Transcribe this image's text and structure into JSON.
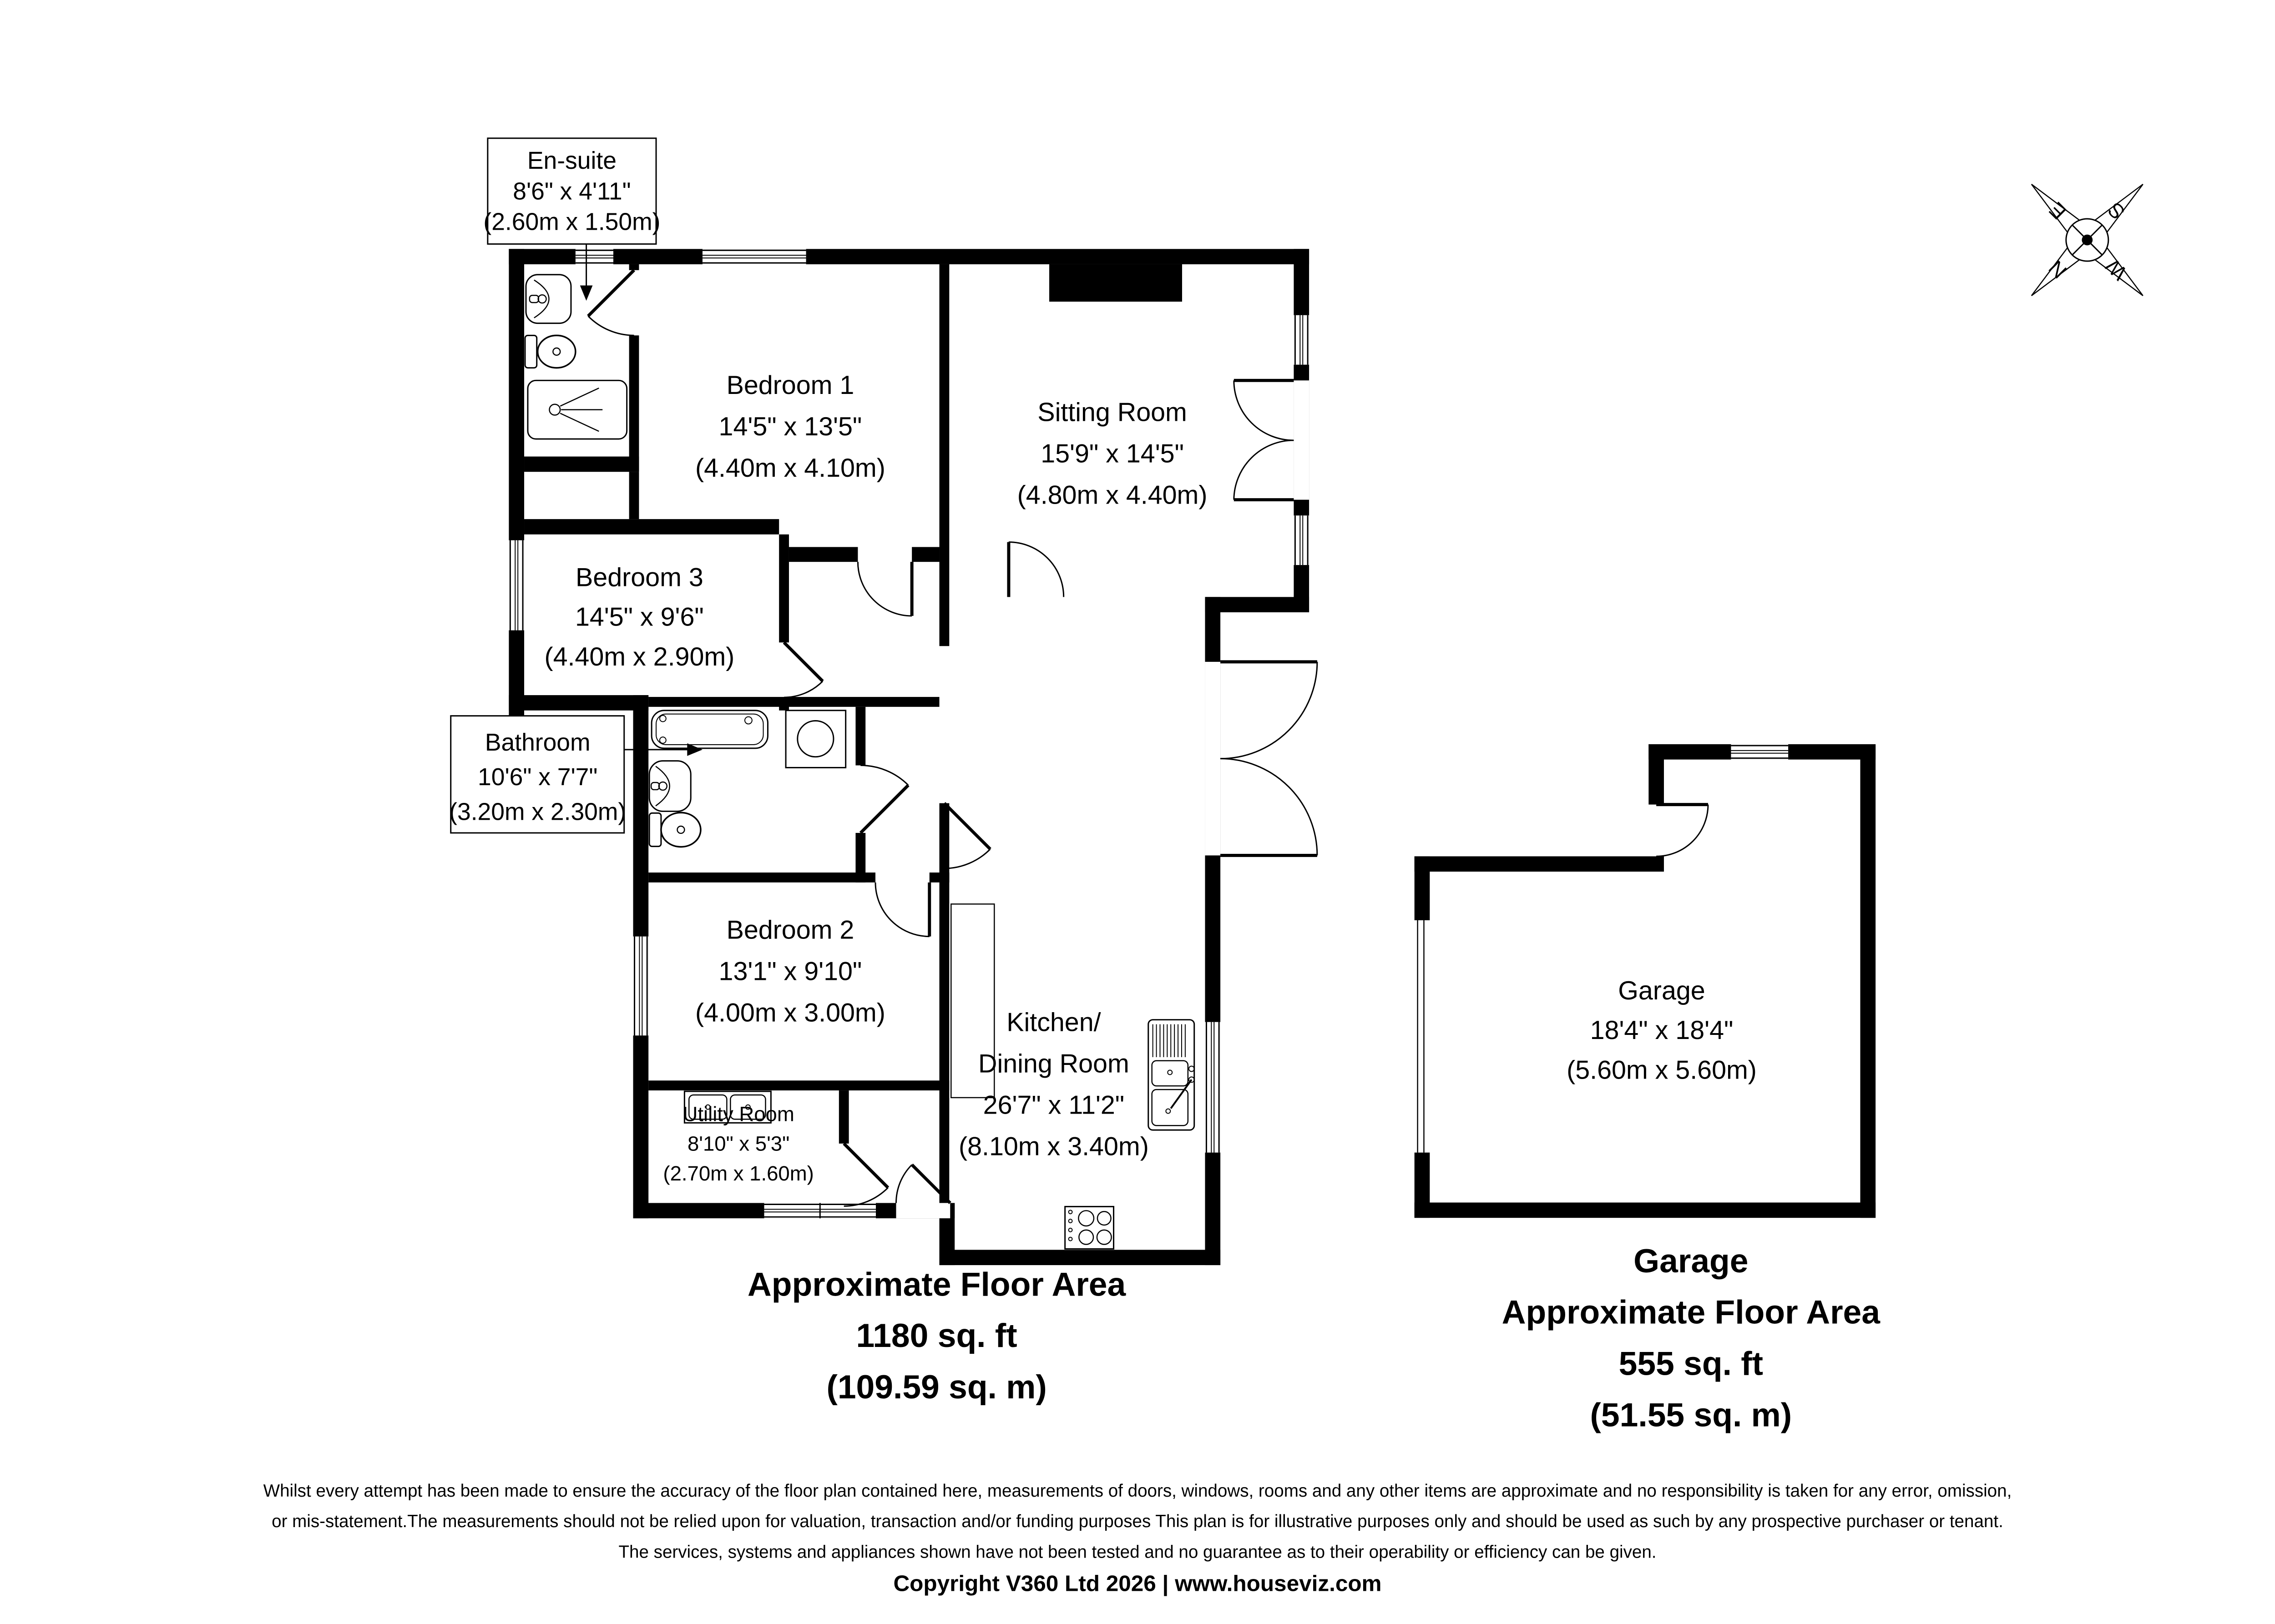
{
  "floorplan": {
    "rooms": {
      "ensuite": {
        "name": "En-suite",
        "imperial": "8'6\" x 4'11\"",
        "metric": "(2.60m x 1.50m)"
      },
      "bedroom1": {
        "name": "Bedroom 1",
        "imperial": "14'5\" x 13'5\"",
        "metric": "(4.40m x 4.10m)"
      },
      "sitting": {
        "name": "Sitting Room",
        "imperial": "15'9\" x 14'5\"",
        "metric": "(4.80m x 4.40m)"
      },
      "bedroom3": {
        "name": "Bedroom 3",
        "imperial": "14'5\" x 9'6\"",
        "metric": "(4.40m x 2.90m)"
      },
      "bathroom": {
        "name": "Bathroom",
        "imperial": "10'6\" x 7'7\"",
        "metric": "(3.20m x 2.30m)"
      },
      "bedroom2": {
        "name": "Bedroom 2",
        "imperial": "13'1\" x 9'10\"",
        "metric": "(4.00m x 3.00m)"
      },
      "kitchen": {
        "name_line1": "Kitchen/",
        "name_line2": "Dining Room",
        "imperial": "26'7\" x 11'2\"",
        "metric": "(8.10m x 3.40m)"
      },
      "utility": {
        "name": "Utility Room",
        "imperial": "8'10\" x 5'3\"",
        "metric": "(2.70m x 1.60m)"
      },
      "garage": {
        "name": "Garage",
        "imperial": "18'4\" x 18'4\"",
        "metric": "(5.60m x 5.60m)"
      }
    },
    "compass": {
      "north": "N",
      "east": "E",
      "south": "S",
      "west": "W"
    },
    "summary_house": {
      "line1": "Approximate Floor Area",
      "line2": "1180 sq. ft",
      "line3": "(109.59 sq. m)"
    },
    "summary_garage": {
      "line1": "Garage",
      "line2": "Approximate Floor Area",
      "line3": "555 sq. ft",
      "line4": "(51.55 sq. m)"
    },
    "disclaimer": {
      "line1": "Whilst every attempt has been made to ensure the accuracy of the floor plan contained here, measurements of doors, windows, rooms and any other items are approximate and no responsibility is taken for any error, omission,",
      "line2": "or mis-statement.The measurements should not be relied upon for valuation, transaction and/or funding purposes This plan is for illustrative purposes only and should be used as such by any prospective purchaser or tenant.",
      "line3": "The services, systems and appliances shown have not been tested and no guarantee as to their operability or efficiency can be given.",
      "copyright": "Copyright V360 Ltd 2026 | www.houseviz.com"
    },
    "colors": {
      "wall": "#000000",
      "background": "#ffffff"
    },
    "fixtures": [
      "bath",
      "shower",
      "toilet",
      "sink",
      "kitchen-sink",
      "hob",
      "utility-sink",
      "hot-water-cylinder"
    ]
  }
}
